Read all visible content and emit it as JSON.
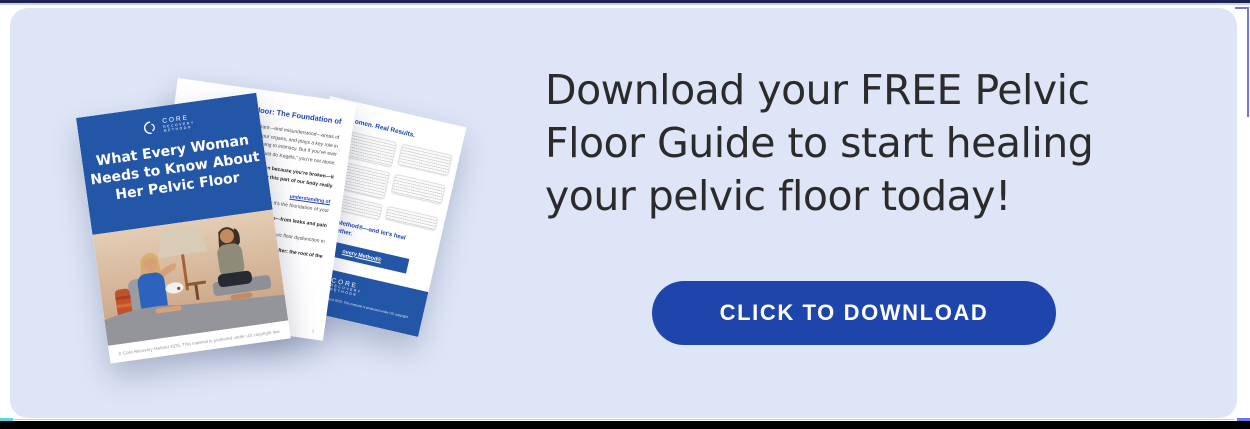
{
  "theme": {
    "card_bg": "#dde5f6",
    "accent_blue": "#1d45ac",
    "cover_blue": "#2456a8",
    "headline_color": "#2b2b2b",
    "bottom_bar": "#000000"
  },
  "cta": {
    "headline_lines": [
      "Download your FREE Pelvic",
      "Floor Guide to start healing",
      "your pelvic floor today!"
    ],
    "button_label": "CLICK TO DOWNLOAD"
  },
  "mockup": {
    "cover": {
      "logo": {
        "icon": "crescent-mark-icon",
        "name_line1": "CORE",
        "name_line2": "RECOVERY",
        "name_line3": "METHOD®"
      },
      "title_lines": [
        "What Every Woman",
        "Needs to Know About",
        "Her Pelvic Floor"
      ],
      "footer_text": "© Core Recovery Method 2025. This material is protected under US copyright law."
    },
    "page_foundation": {
      "heading_fragment": "ic Floor: The Foundation of",
      "body_fragments": [
        "important—and misunderstood—areas of",
        "ports your organs, and plays a key role in",
        "reathing to intimacy. But if you’ve ever",
        "ng to “just do Kegels,” you’re not alone.",
        "ppen because you’re broken—it",
        "t us how this part of our body really",
        "understanding of",
        "nd why it’s the foundation of your",
        "function—from leaks and pain",
        "d pelvic floor dysfunction in",
        "after: the root of the"
      ],
      "footer_fragment": "nder US copyright law.",
      "page_number": "1"
    },
    "page_results": {
      "heading_fragment": "omen. Real Results.",
      "cta_lines": [
        "very Method®—and let’s heal",
        "r, together."
      ],
      "button_fragment": "overy Method®",
      "footer_logo_lines": [
        "CORE",
        "RECOVERY",
        "METHOD®"
      ],
      "footer_fragment": "covery Method 2025. This material is protected under US copyright law."
    }
  }
}
